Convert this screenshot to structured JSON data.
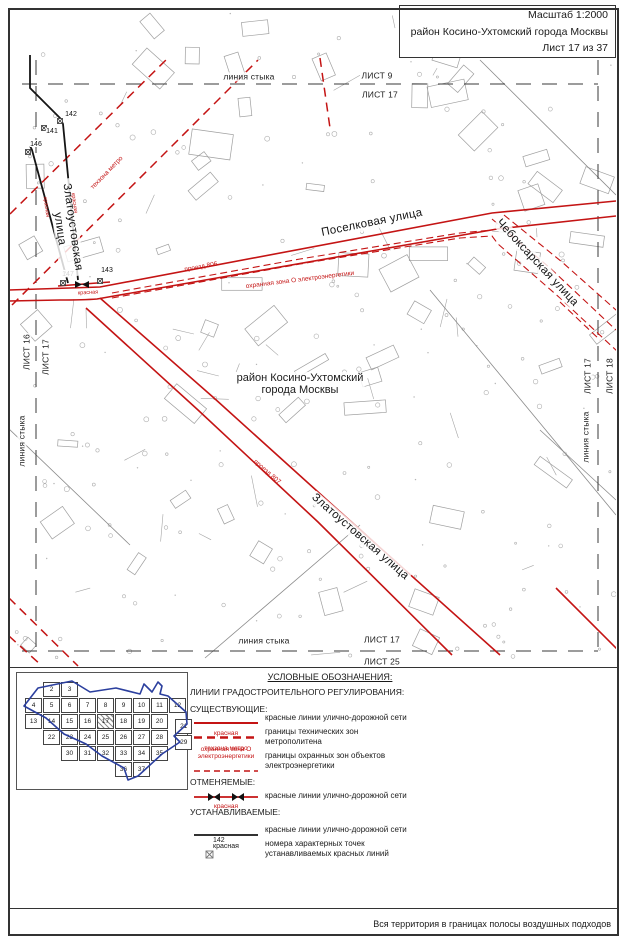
{
  "header": {
    "scale": "Масштаб 1:2000",
    "district": "район Косино-Ухтомский города Москвы",
    "sheet": "Лист 17 из 37"
  },
  "footer": {
    "note": "Вся территория в границах полосы воздушных подходов"
  },
  "colors": {
    "red": "#c41414",
    "blue": "#2b3f9e",
    "gray": "#a9a9a9",
    "black": "#1a1a1a"
  },
  "map": {
    "district_label": "район Косино-Ухтомский\nгорода Москвы",
    "streets": {
      "poselkovaya": "Поселковая улица",
      "cheboksarskaya": "Чебоксарская улица",
      "zlatoustovskaya_top": "Златоустовская улица",
      "zlatoustovskaya_diag": "Златоустовская улица"
    },
    "red_labels": {
      "proezd_806": "проезд 806",
      "proezd_807": "проезд 807",
      "okhr_zona": "охранная зона О электроэнергетики",
      "tekhzona": "техзона метро",
      "krasnaya": "красная"
    },
    "edges": {
      "top": {
        "stitch": "линия стыка",
        "above": "ЛИСТ 9",
        "below": "ЛИСТ 17"
      },
      "bottom": {
        "stitch": "линия стыка",
        "above": "ЛИСТ 17",
        "below": "ЛИСТ 25"
      },
      "left": {
        "stitch": "линия стыка",
        "outer": "ЛИСТ 16",
        "inner": "ЛИСТ 17"
      },
      "right": {
        "stitch": "линия стыка",
        "inner": "ЛИСТ 17",
        "outer": "ЛИСТ 18"
      }
    },
    "points": [
      {
        "n": "142",
        "mx": 60,
        "my": 121,
        "lx": 71,
        "ly": 116
      },
      {
        "n": "141",
        "mx": 44,
        "my": 128,
        "lx": 52,
        "ly": 133
      },
      {
        "n": "146",
        "mx": 28,
        "my": 152,
        "lx": 36,
        "ly": 146
      },
      {
        "n": "147",
        "mx": 63,
        "my": 283,
        "lx": 68,
        "ly": 276
      },
      {
        "n": "143",
        "mx": 100,
        "my": 281,
        "lx": 107,
        "ly": 272
      }
    ]
  },
  "sheet_index": {
    "current": 17,
    "cells": [
      {
        "n": 2,
        "col": 1,
        "row": 0
      },
      {
        "n": 3,
        "col": 2,
        "row": 0
      },
      {
        "n": 4,
        "col": 0,
        "row": 1
      },
      {
        "n": 5,
        "col": 1,
        "row": 1
      },
      {
        "n": 6,
        "col": 2,
        "row": 1
      },
      {
        "n": 7,
        "col": 3,
        "row": 1
      },
      {
        "n": 8,
        "col": 4,
        "row": 1
      },
      {
        "n": 9,
        "col": 5,
        "row": 1
      },
      {
        "n": 10,
        "col": 6,
        "row": 1
      },
      {
        "n": 11,
        "col": 7,
        "row": 1
      },
      {
        "n": 12,
        "col": 8,
        "row": 1
      },
      {
        "n": 13,
        "col": 0,
        "row": 2
      },
      {
        "n": 14,
        "col": 1,
        "row": 2
      },
      {
        "n": 15,
        "col": 2,
        "row": 2
      },
      {
        "n": 16,
        "col": 3,
        "row": 2
      },
      {
        "n": 17,
        "col": 4,
        "row": 2
      },
      {
        "n": 18,
        "col": 5,
        "row": 2
      },
      {
        "n": 19,
        "col": 6,
        "row": 2
      },
      {
        "n": 20,
        "col": 7,
        "row": 2
      },
      {
        "n": 21,
        "col": 8.35,
        "row": 2.3
      },
      {
        "n": 22,
        "col": 1,
        "row": 3
      },
      {
        "n": 23,
        "col": 2,
        "row": 3
      },
      {
        "n": 24,
        "col": 3,
        "row": 3
      },
      {
        "n": 25,
        "col": 4,
        "row": 3
      },
      {
        "n": 26,
        "col": 5,
        "row": 3
      },
      {
        "n": 27,
        "col": 6,
        "row": 3
      },
      {
        "n": 28,
        "col": 7,
        "row": 3
      },
      {
        "n": 29,
        "col": 8.35,
        "row": 3.3
      },
      {
        "n": 30,
        "col": 2,
        "row": 4
      },
      {
        "n": 31,
        "col": 3,
        "row": 4
      },
      {
        "n": 32,
        "col": 4,
        "row": 4
      },
      {
        "n": 33,
        "col": 5,
        "row": 4
      },
      {
        "n": 34,
        "col": 6,
        "row": 4
      },
      {
        "n": 35,
        "col": 7,
        "row": 4
      },
      {
        "n": 36,
        "col": 5,
        "row": 5
      },
      {
        "n": 37,
        "col": 6,
        "row": 5
      }
    ]
  },
  "legend": {
    "title": "УСЛОВНЫЕ ОБОЗНАЧЕНИЯ:",
    "section": "ЛИНИИ ГРАДОСТРОИТЕЛЬНОГО РЕГУЛИРОВАНИЯ:",
    "existing_heading": "СУЩЕСТВУЮЩИЕ:",
    "item_red": {
      "label": "красная",
      "desc": "красные линии улично-дорожной сети"
    },
    "item_metro": {
      "label": "техзона метро",
      "desc": "границы технических зон\nметрополитена"
    },
    "item_okhr": {
      "label": "охранная зона О\nэлектроэнергетики",
      "desc": "границы охранных зон объектов\nэлектроэнергетики"
    },
    "cancelled_heading": "ОТМЕНЯЕМЫЕ:",
    "item_cancelled": {
      "label": "красная",
      "desc": "красные линии улично-дорожной сети"
    },
    "established_heading": "УСТАНАВЛИВАЕМЫЕ:",
    "item_est": {
      "label": "красная",
      "desc": "красные линии улично-дорожной сети"
    },
    "item_point": {
      "label": "142",
      "desc": "номера характерных точек\nустанавливаемых красных линий"
    }
  }
}
